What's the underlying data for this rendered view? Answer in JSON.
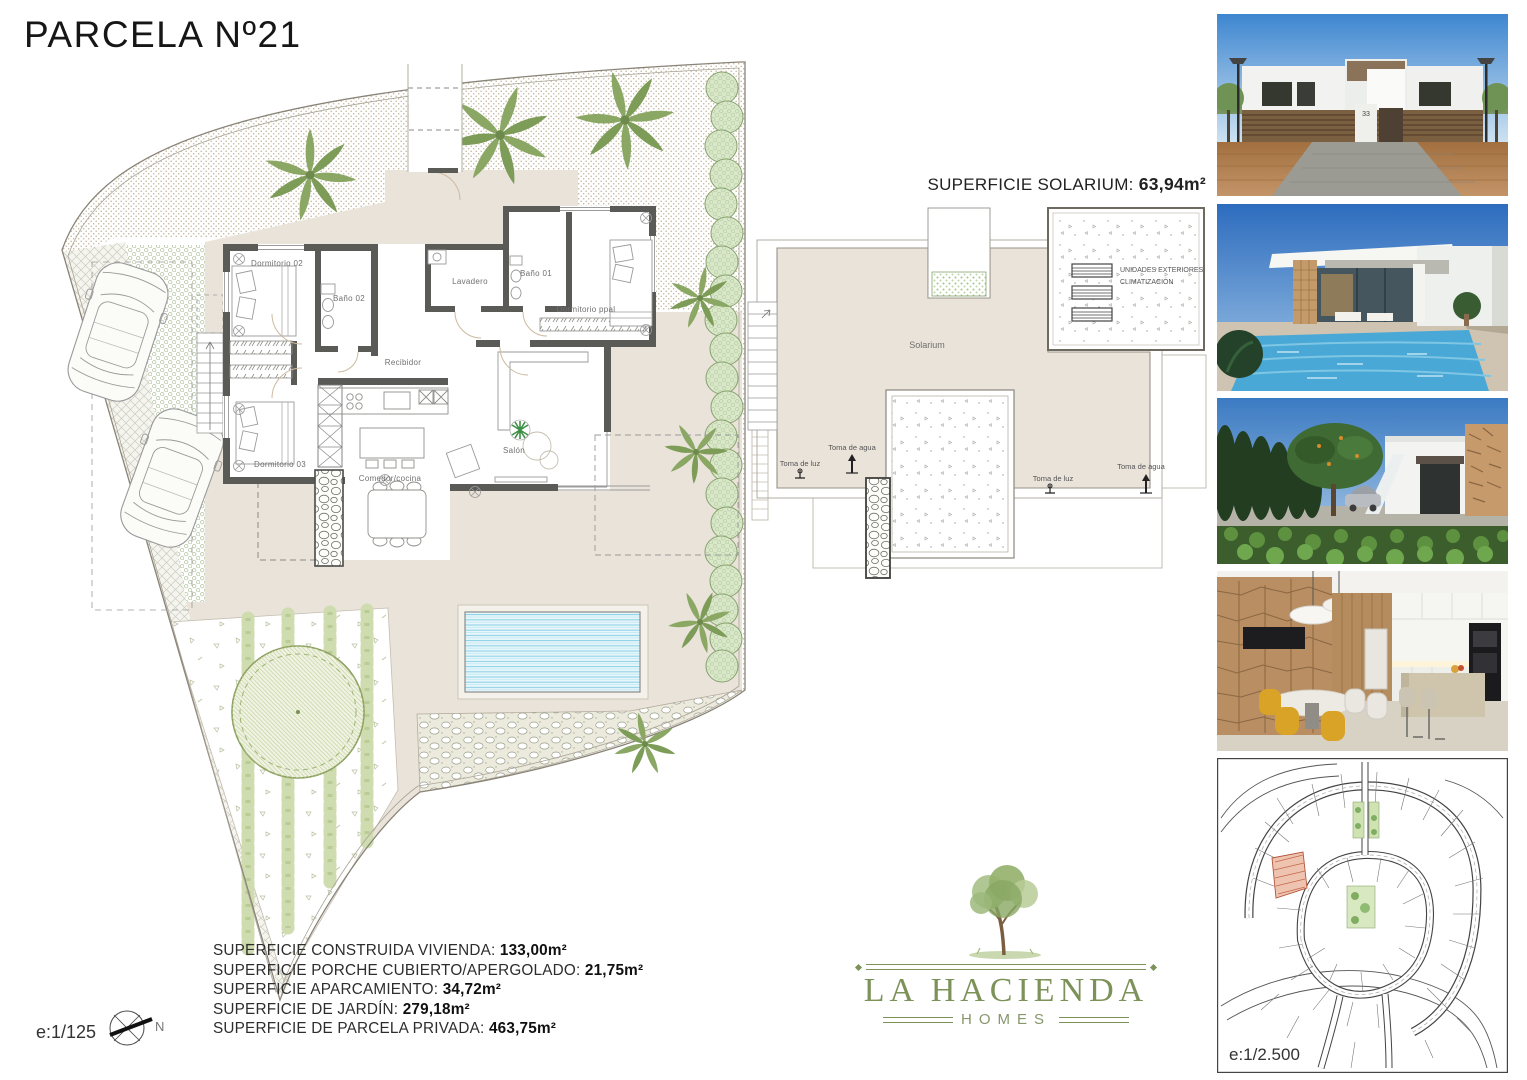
{
  "page": {
    "title": "PARCELA Nº21"
  },
  "floor_plan": {
    "scale": "e:1/125",
    "north_label": "N",
    "rooms": {
      "dormitorio02": "Dormitorio 02",
      "bano02": "Baño 02",
      "lavadero": "Lavadero",
      "bano01": "Baño 01",
      "dormitorio_ppal": "Dormitorio ppal",
      "recibidor": "Recibidor",
      "dormitorio03": "Dormitorio 03",
      "comedor_cocina": "Comedor/cocina",
      "salon": "Salón"
    }
  },
  "solarium_plan": {
    "heading_label": "SUPERFICIE SOLARIUM: ",
    "heading_value": "63,94m²",
    "room_label": "Solarium",
    "ac_units_line1": "UNIDADES EXTERIORES",
    "ac_units_line2": "CLIMATIZACIÓN",
    "toma_agua_left": "Toma de agua",
    "toma_luz_left": "Toma de luz",
    "toma_luz_right": "Toma de luz",
    "toma_agua_right": "Toma de agua"
  },
  "areas": {
    "items": [
      {
        "label": "SUPERFICIE CONSTRUIDA VIVIENDA: ",
        "value": "133,00m²"
      },
      {
        "label": "SUPERFICIE PORCHE CUBIERTO/APERGOLADO: ",
        "value": "21,75m²"
      },
      {
        "label": "SUPERFICIE APARCAMIENTO: ",
        "value": "34,72m²"
      },
      {
        "label": "SUPERFICIE DE JARDÍN: ",
        "value": "279,18m²"
      },
      {
        "label": "SUPERFICIE DE PARCELA PRIVADA: ",
        "value": "463,75m²"
      }
    ]
  },
  "logo": {
    "name": "LA HACIENDA",
    "subtitle": "HOMES"
  },
  "site_map": {
    "scale": "e:1/2.500"
  },
  "photos": {
    "street_facade": {
      "name": "street-facade-render",
      "house_number": "33"
    },
    "pool_villa": {
      "name": "pool-villa-render"
    },
    "garden_side": {
      "name": "garden-side-render"
    },
    "interior_kitchen": {
      "name": "interior-kitchen-render"
    }
  },
  "colors": {
    "logo_green": "#7c9258",
    "plan_beige": "#e9e3da",
    "pool_blue": "#bfe6f2",
    "parcel_red": "#c97e5f"
  }
}
